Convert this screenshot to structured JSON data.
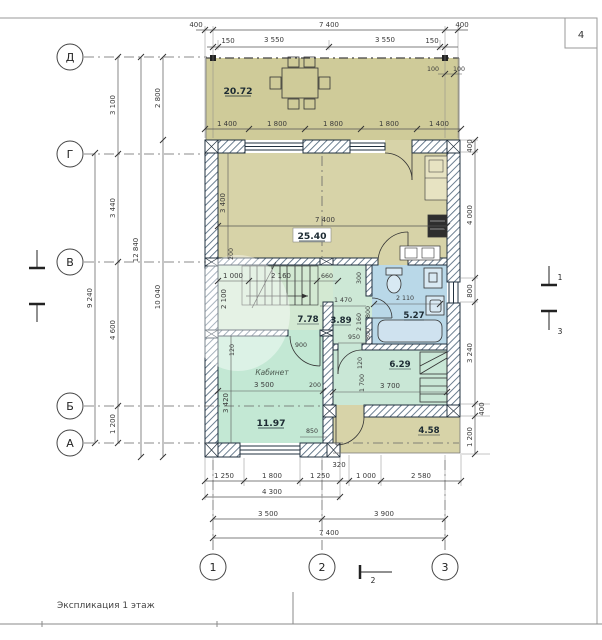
{
  "page": {
    "sheet": "4",
    "footer": "Экспликация 1 этаж"
  },
  "axes": {
    "rows": [
      "Д",
      "Г",
      "В",
      "Б",
      "А"
    ],
    "cols": [
      "1",
      "2",
      "3"
    ]
  },
  "sections": {
    "s1": "1",
    "s2": "2",
    "s3": "3"
  },
  "rooms": {
    "terrace": {
      "area": "20.72"
    },
    "living": {
      "area": "25.40"
    },
    "hall": {
      "area": "7.78"
    },
    "corridor": {
      "area": "3.89"
    },
    "bath": {
      "area": "5.27"
    },
    "util": {
      "area": "6.29"
    },
    "office": {
      "area": "11.97",
      "label": "Кабинет"
    },
    "porch": {
      "area": "4.58"
    }
  },
  "dims": {
    "top1": [
      "400",
      "7 400",
      "400"
    ],
    "top2": [
      "150",
      "3 550",
      "3 550",
      "150"
    ],
    "top3": [
      "100",
      "100"
    ],
    "terrace_bottom": [
      "1 400",
      "1 800",
      "1 800",
      "1 800",
      "1 400"
    ],
    "left": {
      "d9240": "9 240",
      "d3100": "3 100",
      "d3440": "3 440",
      "d4600": "4 600",
      "d1200": "1 200",
      "d12840": "12 840",
      "d2800": "2 800",
      "d10040": "10 040"
    },
    "right": [
      "400",
      "4 000",
      "800",
      "3 240",
      "400",
      "1 200"
    ],
    "bottom1": [
      "1 250",
      "1 800",
      "1 250",
      "320",
      "1 000",
      "2 580"
    ],
    "bottom2": "4 300",
    "bottom3": [
      "3 500",
      "3 900"
    ],
    "bottom4": "7 400",
    "living": {
      "w": "7 400",
      "h": "3 400",
      "off": "200"
    },
    "stairs": {
      "a": "1 000",
      "b": "2 160",
      "c": "660",
      "h": "2 100",
      "off": "120"
    },
    "hall": {
      "w": "1 470",
      "h": "2 160",
      "pass": "950",
      "door": "900"
    },
    "bath": {
      "w": "2 110",
      "off": "300",
      "w1": "800",
      "w2": "800"
    },
    "util": {
      "w": "3 700",
      "h": "1 700",
      "off": "120"
    },
    "office": {
      "w": "3 500",
      "h": "3 420",
      "gap": "200",
      "win": "850"
    }
  },
  "colors": {
    "terrace": "#cfcb99",
    "living": "#d7d3a8",
    "hall": "#d3e9d2",
    "corridor": "#cde8d6",
    "bath": "#b9d8e8",
    "util": "#c9e7d6",
    "office": "#c3e8d4",
    "porch": "#d7d3a8",
    "wall_stroke": "#22313f",
    "hatch": "#51687d",
    "dim": "#3a3a3a"
  }
}
